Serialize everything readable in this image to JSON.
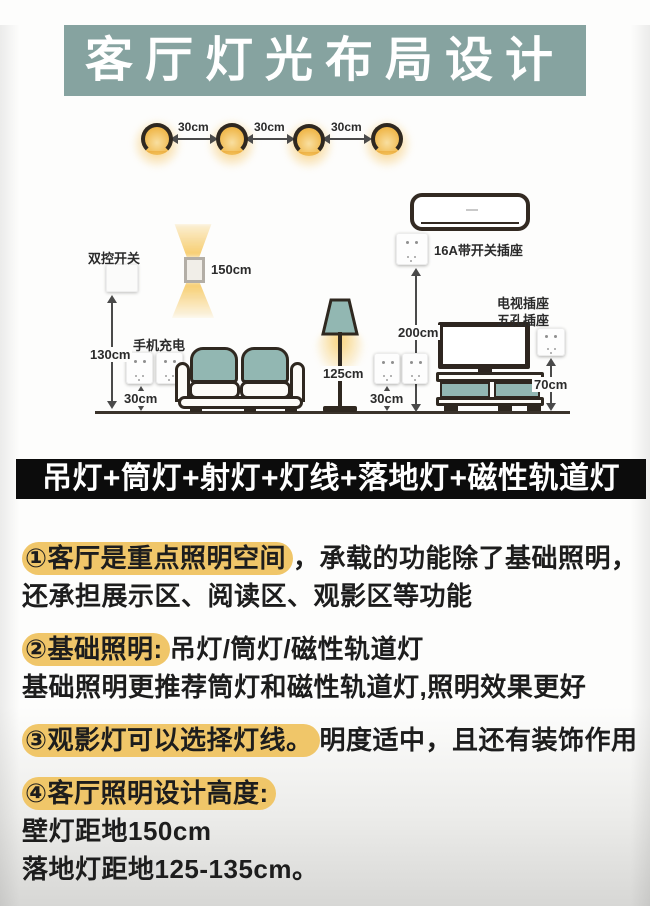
{
  "title": "客厅灯光布局设计",
  "banner": "吊灯+筒灯+射灯+灯线+落地灯+磁性轨道灯",
  "colors": {
    "title_bg": "#86a3a0",
    "highlight": "#f0c669",
    "banner_bg": "#0c0c0c",
    "furniture_teal": "#92b7b2",
    "lamp_glow": "#f6c35c",
    "outline": "#2f2820"
  },
  "diagram": {
    "spacing": [
      "30cm",
      "30cm",
      "30cm"
    ],
    "switch_label": "双控开关",
    "wall_lamp_height": "150cm",
    "switch_height": "130cm",
    "phone_charging": "手机充电",
    "sofa_socket_height": "30cm",
    "floor_lamp_height": "125cm",
    "ac_socket_label": "16A带开关插座",
    "ac_socket_height": "200cm",
    "lamp_socket_height": "30cm",
    "tv_socket_label_1": "电视插座",
    "tv_socket_label_2": "五孔插座",
    "tv_socket_height": "70cm"
  },
  "sections": {
    "s1": {
      "hl": "①客厅是重点照明空间",
      "rest": "，承载的功能除了基础照明，",
      "line2": "还承担展示区、阅读区、观影区等功能"
    },
    "s2": {
      "hl": "②基础照明:",
      "rest": "吊灯/筒灯/磁性轨道灯",
      "line2": "基础照明更推荐筒灯和磁性轨道灯,照明效果更好"
    },
    "s3": {
      "hl": "③观影灯可以选择灯线。",
      "rest": "明度适中，且还有装饰作用"
    },
    "s4": {
      "hl": "④客厅照明设计高度:",
      "line2": "壁灯距地150cm",
      "line3": "落地灯距地125-135cm。"
    }
  }
}
